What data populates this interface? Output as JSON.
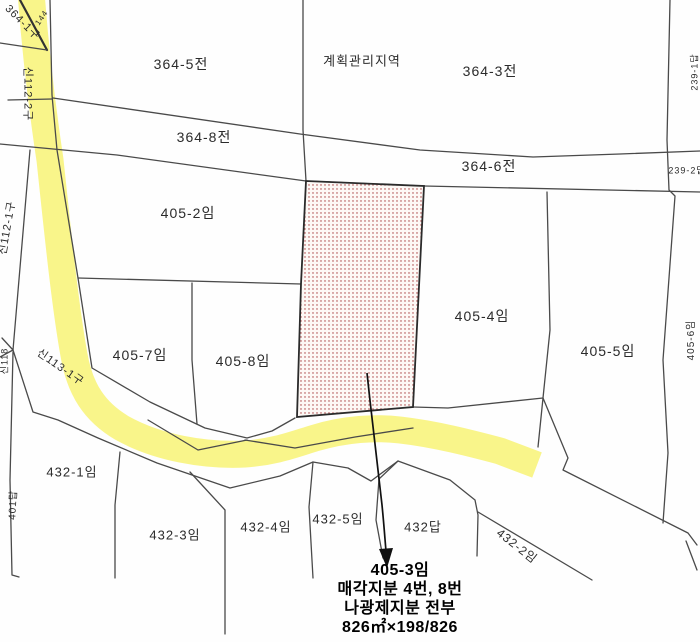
{
  "colors": {
    "road_highlight": "#F8F480",
    "boundary": "#4a4a4a",
    "subject_dots": "#A63A3A",
    "subject_border": "#2b2b2b",
    "arrow": "#111111",
    "label": "#2b2b2b"
  },
  "map": {
    "zone_label": "계획관리지역",
    "labels": {
      "p364_1gu": "364-1구",
      "p144": "144",
      "s112_2": "신112-2구",
      "s112_1": "신112-1구",
      "s113_1": "신113-1구",
      "s118": "신118",
      "p364_5": "364-5전",
      "p364_3": "364-3전",
      "p364_8": "364-8전",
      "p364_6": "364-6전",
      "p239_1": "239-1답",
      "p239_2": "239-2답",
      "p405_2": "405-2임",
      "p405_4": "405-4임",
      "p405_5": "405-5임",
      "p405_6": "405-6임",
      "p405_7": "405-7임",
      "p405_8": "405-8임",
      "p401": "401답",
      "p432_1": "432-1임",
      "p432_3": "432-3임",
      "p432_4": "432-4임",
      "p432_5": "432-5임",
      "p432": "432답",
      "p432_2": "432-2임"
    },
    "annotation": {
      "lines": [
        "405-3임",
        "매각지분 4번, 8번",
        "나광제지분 전부",
        "826㎡×198/826"
      ]
    }
  }
}
